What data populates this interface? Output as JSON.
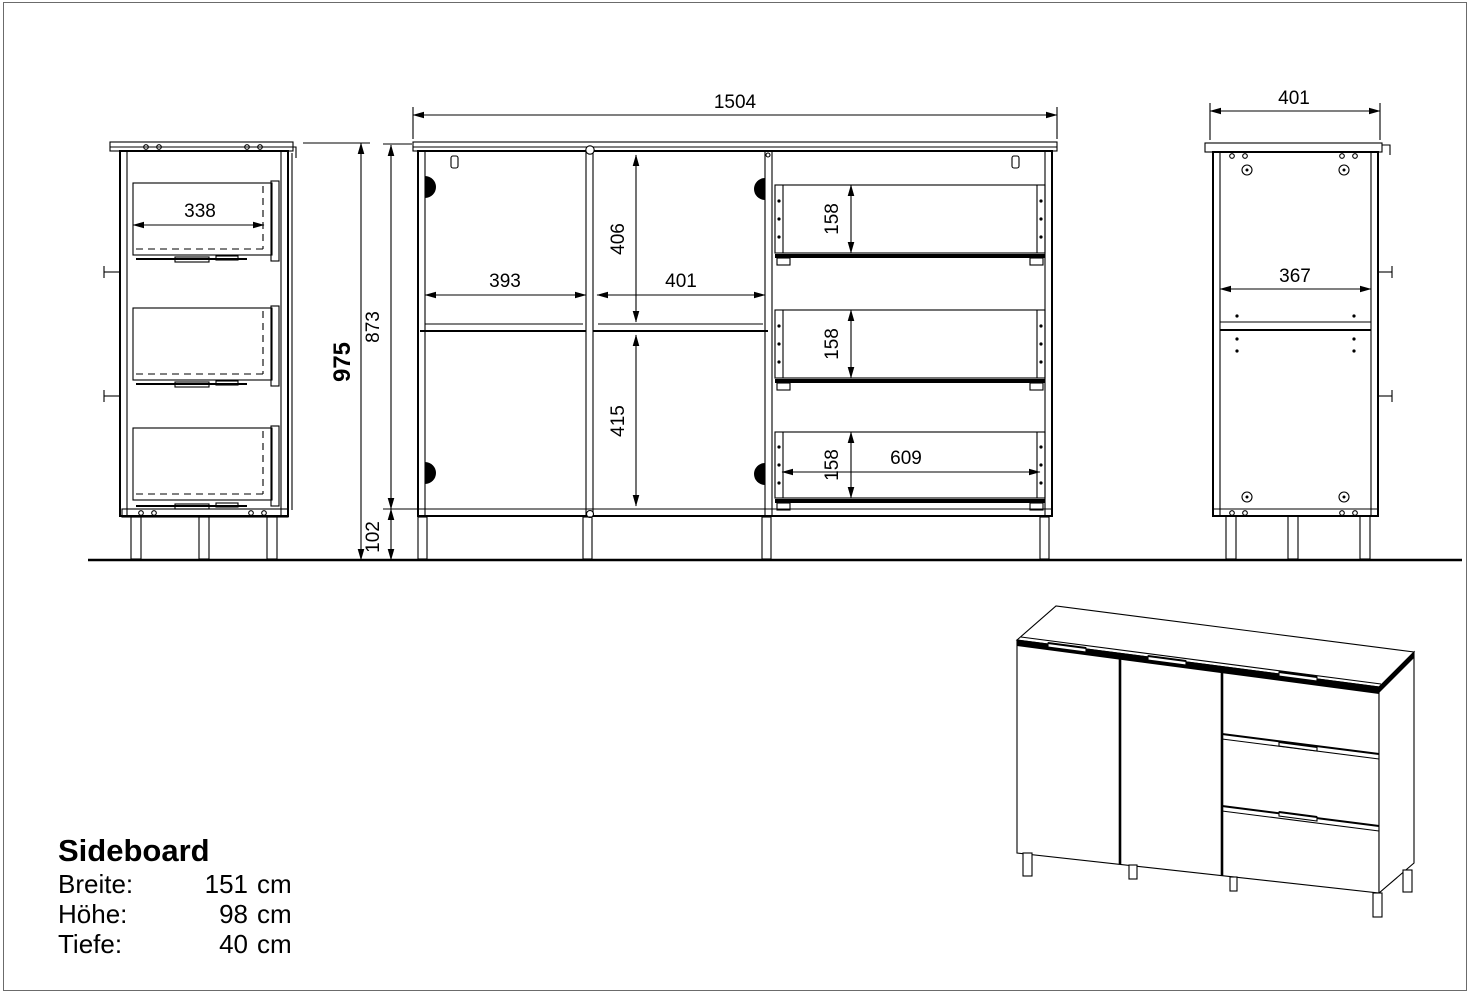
{
  "drawing": {
    "dims": {
      "front_width": "1504",
      "side_depth": "401",
      "side_inner_depth": "367",
      "left_drawer_depth": "338",
      "total_height": "975",
      "body_height": "873",
      "leg_height": "102",
      "left_door_width": "393",
      "middle_door_width": "401",
      "upper_section_height": "406",
      "lower_section_height": "415",
      "drawer_height_top": "158",
      "drawer_height_middle": "158",
      "drawer_height_bottom": "158",
      "drawer_front_width": "609"
    }
  },
  "title_block": {
    "title": "Sideboard",
    "specs": [
      {
        "label": "Breite:",
        "value": "151",
        "unit": "cm"
      },
      {
        "label": "Höhe:",
        "value": "98",
        "unit": "cm"
      },
      {
        "label": "Tiefe:",
        "value": "40",
        "unit": "cm"
      }
    ]
  }
}
